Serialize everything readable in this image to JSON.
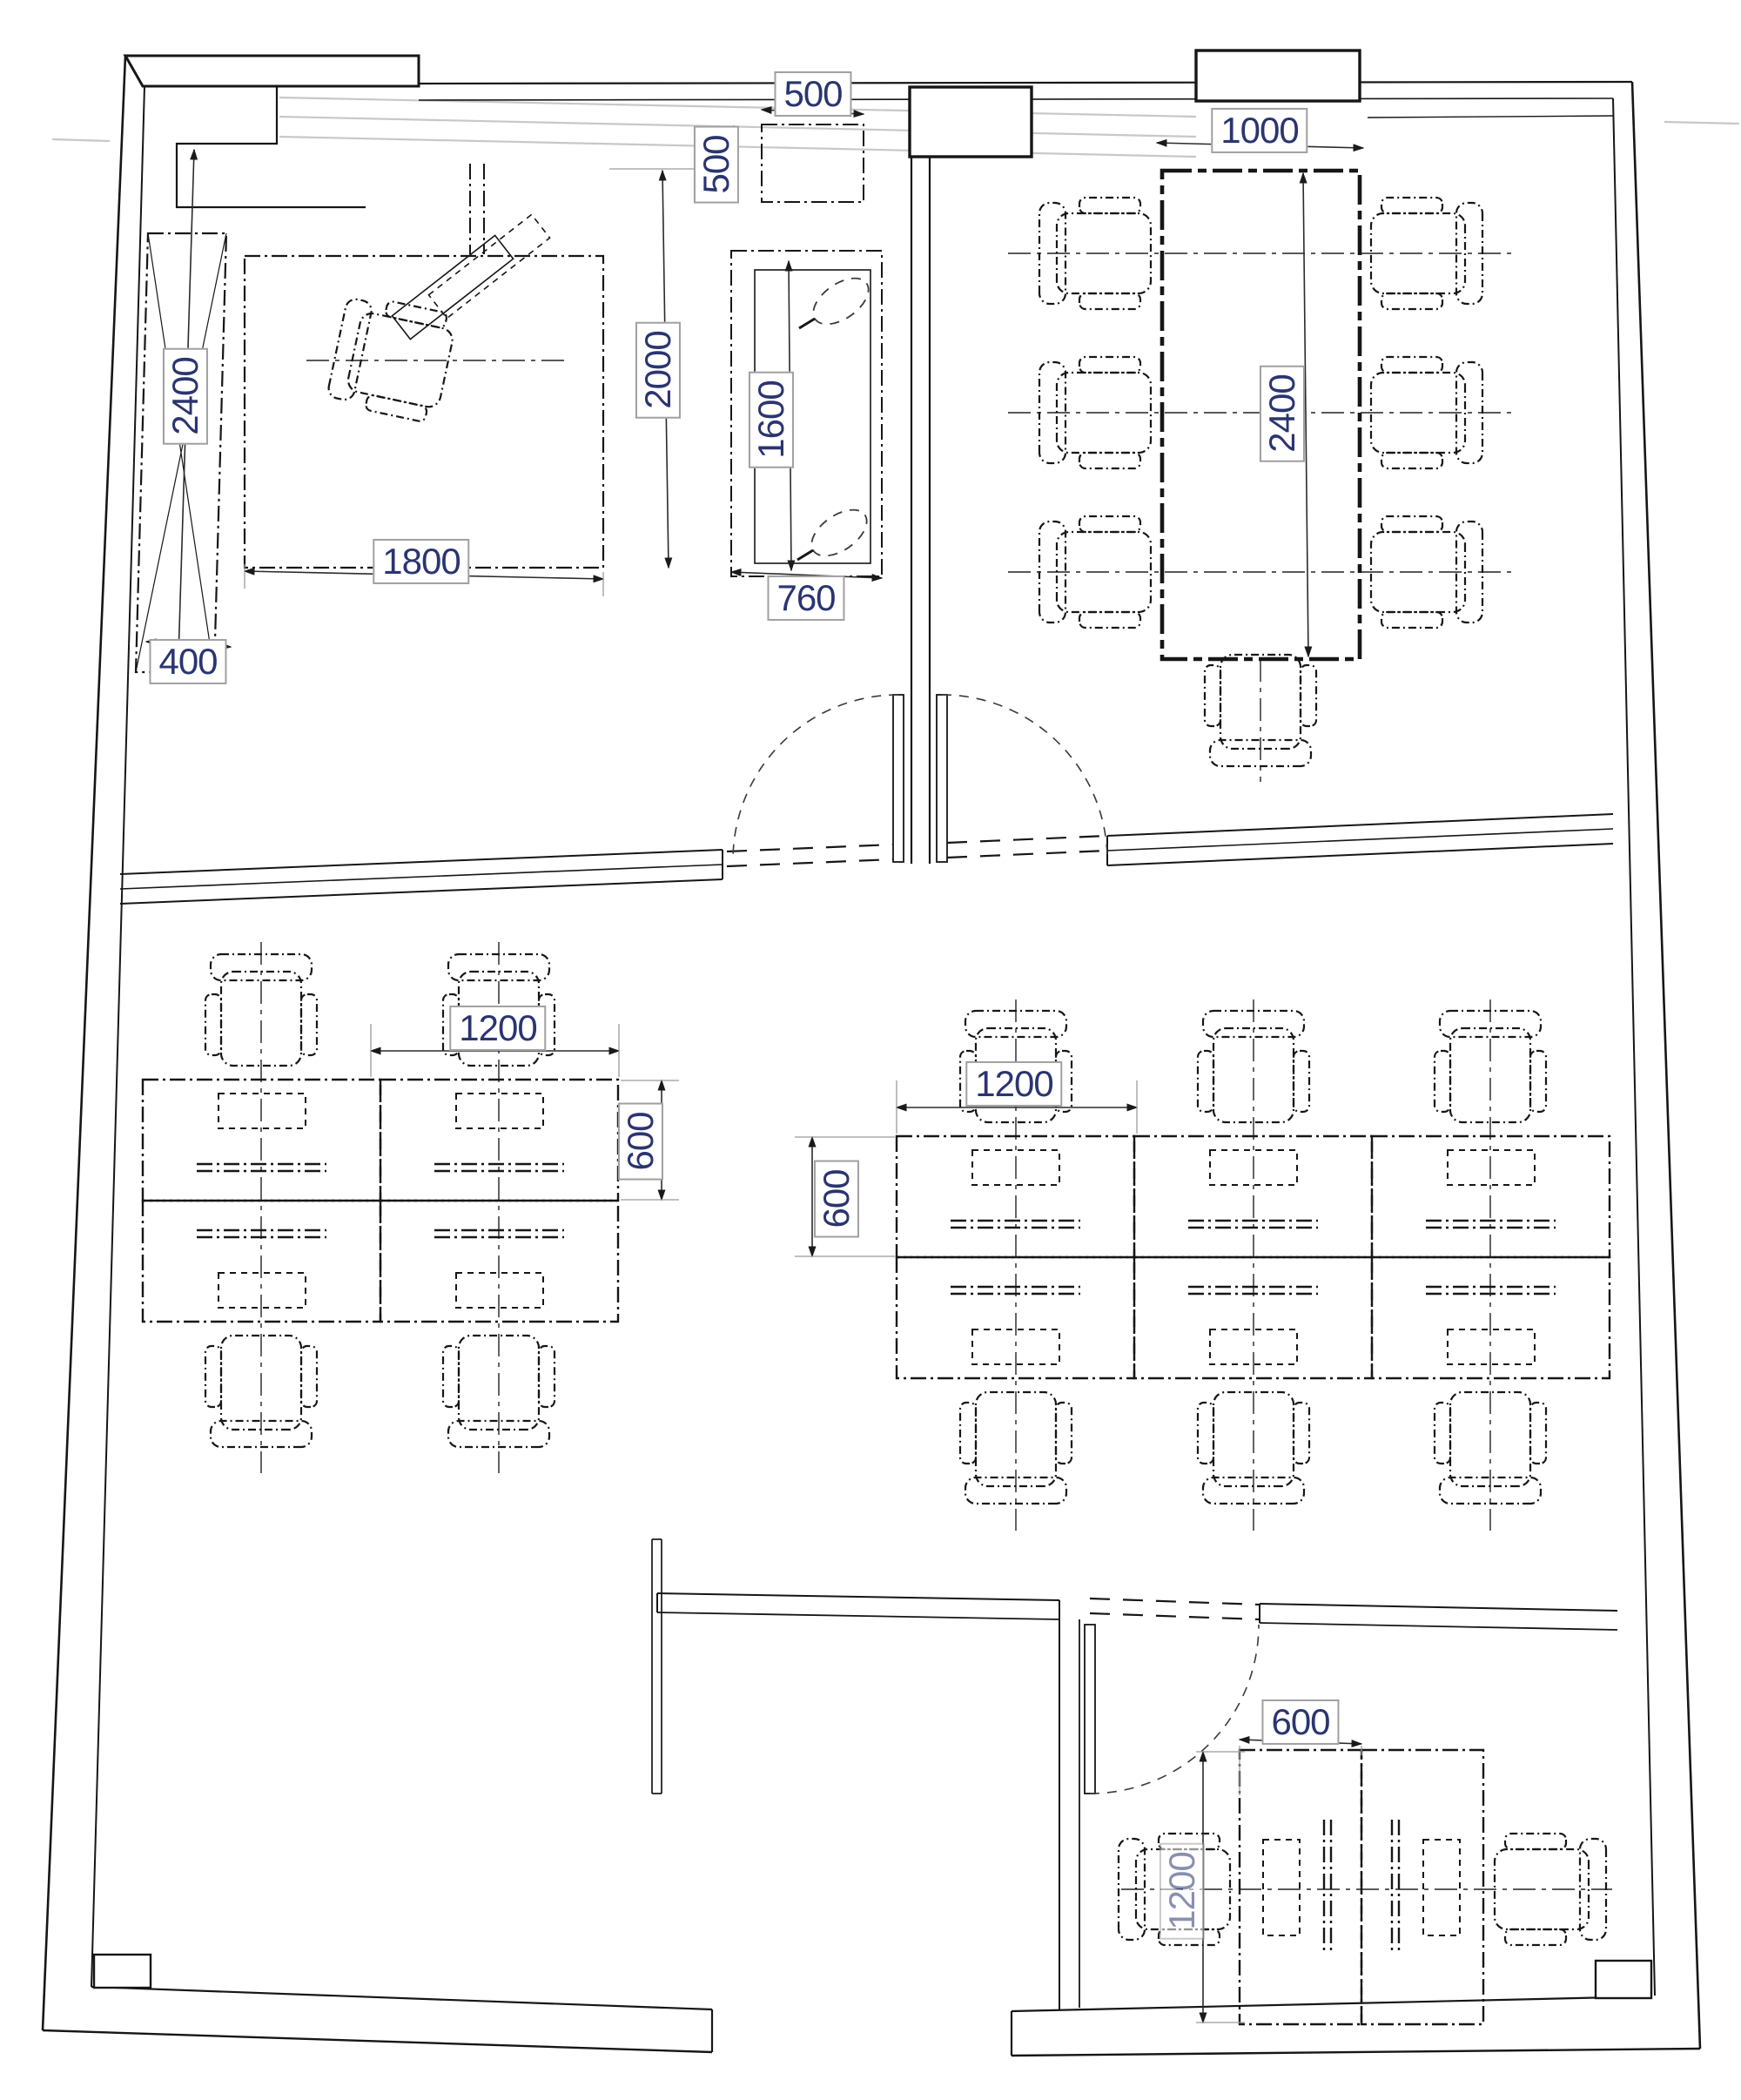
{
  "drawing": {
    "type": "office furniture layout floor plan",
    "units": "mm"
  },
  "colors": {
    "background": "#ffffff",
    "line": "#161616",
    "dim_text": "#2a3570",
    "label_border": "#a0a0a0",
    "curtain_wall_gray": "#c8c8c8"
  },
  "labels": [
    {
      "id": "wardrobe-length",
      "text": "2400",
      "orientation": "vertical"
    },
    {
      "id": "exec-desk-width",
      "text": "1800",
      "orientation": "horizontal"
    },
    {
      "id": "wardrobe-depth",
      "text": "400",
      "orientation": "horizontal"
    },
    {
      "id": "exec-room-depth",
      "text": "2000",
      "orientation": "vertical"
    },
    {
      "id": "cabinet-width",
      "text": "500",
      "orientation": "horizontal"
    },
    {
      "id": "cabinet-depth",
      "text": "500",
      "orientation": "vertical"
    },
    {
      "id": "sideboard-length",
      "text": "1600",
      "orientation": "vertical"
    },
    {
      "id": "sideboard-width",
      "text": "760",
      "orientation": "horizontal"
    },
    {
      "id": "conference-table-width",
      "text": "1000",
      "orientation": "horizontal"
    },
    {
      "id": "conference-table-length",
      "text": "2400",
      "orientation": "vertical"
    },
    {
      "id": "left-cluster-desk-width",
      "text": "1200",
      "orientation": "horizontal"
    },
    {
      "id": "left-cluster-desk-depth",
      "text": "600",
      "orientation": "vertical"
    },
    {
      "id": "right-cluster-desk-width",
      "text": "1200",
      "orientation": "horizontal"
    },
    {
      "id": "right-cluster-desk-depth",
      "text": "600",
      "orientation": "vertical"
    },
    {
      "id": "small-office-desk-width",
      "text": "600",
      "orientation": "horizontal"
    },
    {
      "id": "small-office-desk-length",
      "text": "1200",
      "orientation": "vertical"
    }
  ]
}
